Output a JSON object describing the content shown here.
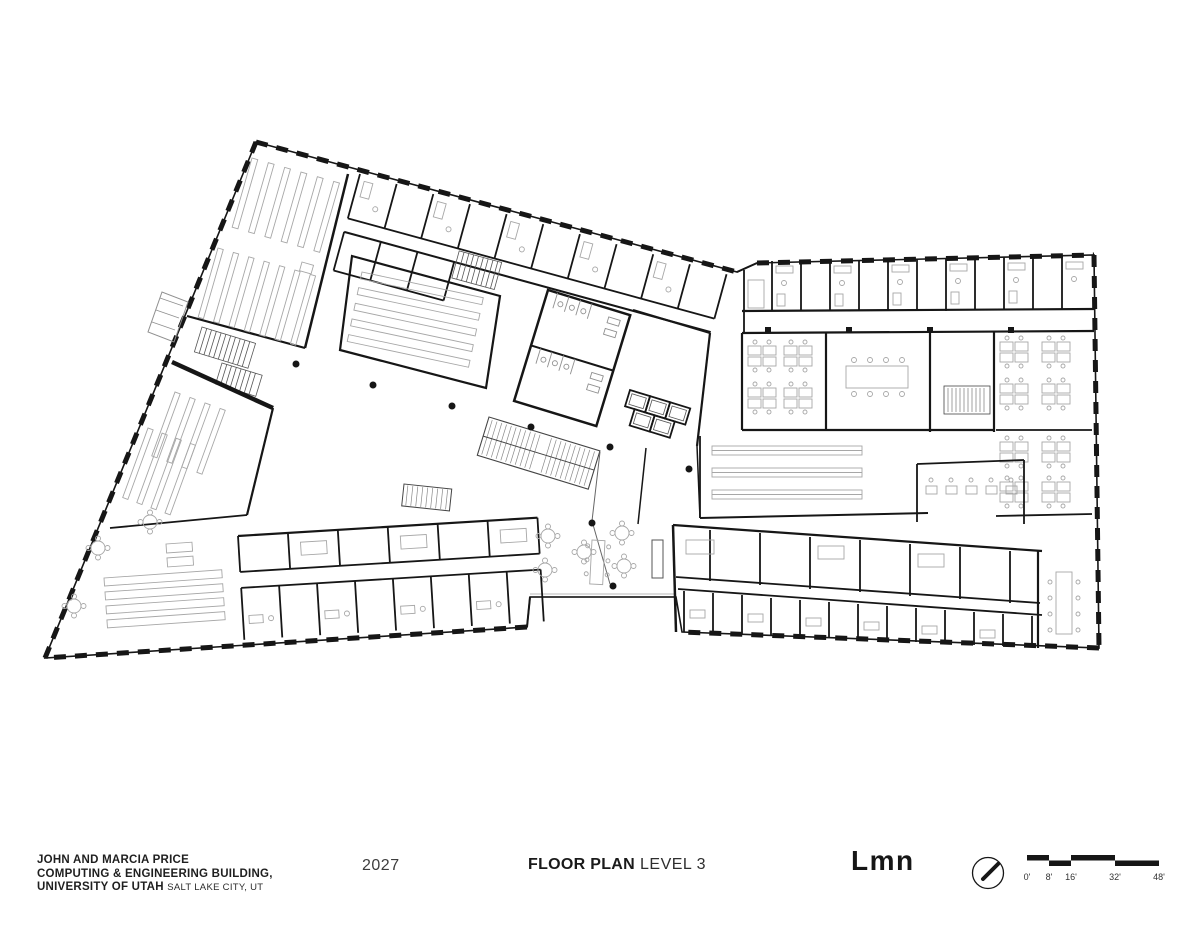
{
  "titlebar": {
    "project_line1": "JOHN AND MARCIA PRICE",
    "project_line2": "COMPUTING & ENGINEERING BUILDING,",
    "project_line3": "UNIVERSITY OF UTAH",
    "project_location": "SALT LAKE CITY, UT",
    "year": "2027",
    "sheet_title": "FLOOR PLAN",
    "sheet_subtitle": "LEVEL 3",
    "firm_logo": "Lmn"
  },
  "scalebar": {
    "labels": [
      "0'",
      "8'",
      "16'",
      "32'",
      "48'"
    ],
    "tick_feet": [
      0,
      8,
      16,
      32,
      48
    ]
  },
  "north_arrow": {
    "direction": "northeast"
  },
  "colors": {
    "ink": "#161616",
    "furniture": "#a7a7a7",
    "hatch": "#8f8f8f",
    "background": "#ffffff"
  }
}
